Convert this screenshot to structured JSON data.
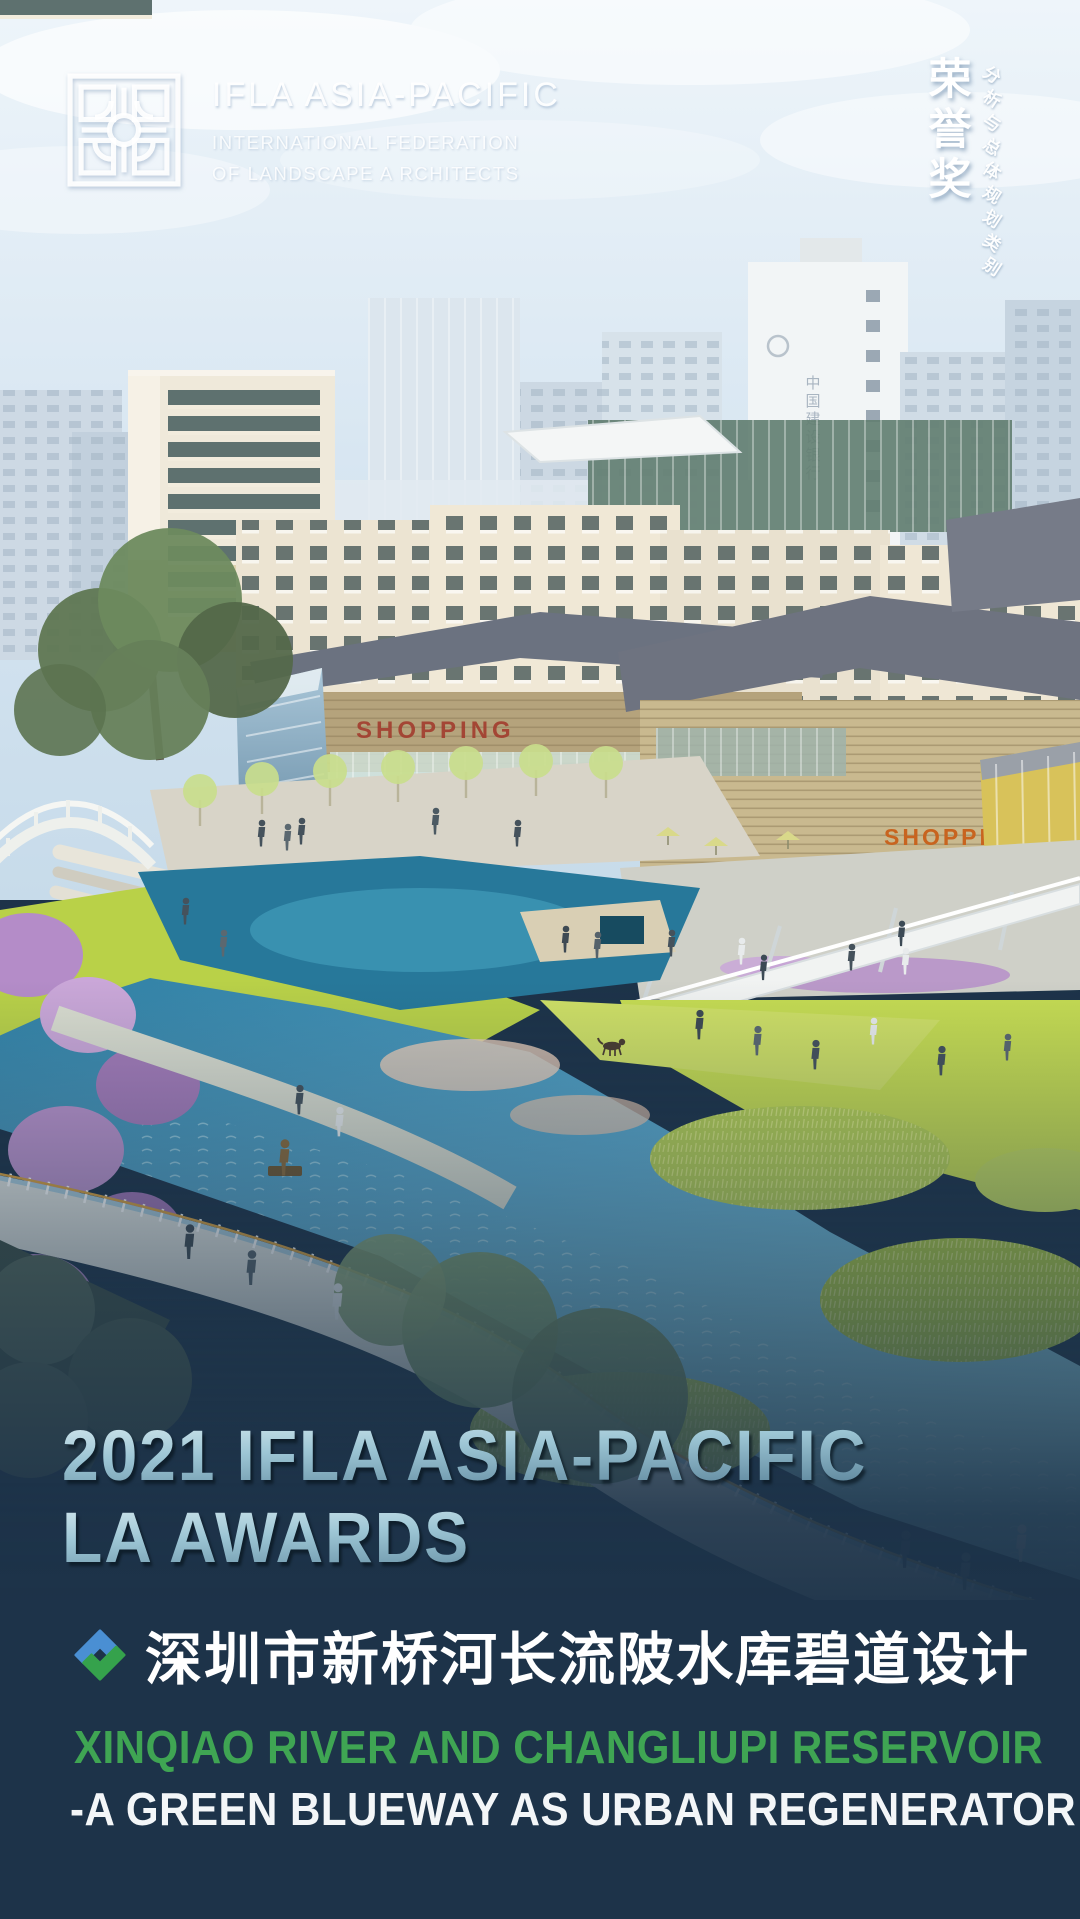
{
  "header": {
    "logo_icon": "ifla-apr-geometric-logo",
    "org_title": "IFLA ASIA-PACIFIC",
    "org_subtitle_line1": "INTERNATIONAL FEDERATION",
    "org_subtitle_line2": "OF LANDSCAPE A RCHITECTS"
  },
  "award_badge": {
    "award_name": "荣誉奖",
    "category": "分析与总体规划类别"
  },
  "scene": {
    "description": "aerial rendering of a green-blue riverside urban regeneration with shopping streets, lawns, wetlands and a winding promenade",
    "signs": {
      "bank_sign": "中国建设银行",
      "mall_sign_center": "SHOPPING",
      "mall_sign_right": "SHOPPI"
    }
  },
  "title_block": {
    "line1": "2021 IFLA ASIA-PACIFIC",
    "line2": "LA AWARDS"
  },
  "project": {
    "badge_icon": "interlocked-diamond-logo",
    "title_zh": "深圳市新桥河长流陂水库碧道设计",
    "subtitle_en_line1": "XINQIAO RIVER AND CHANGLIUPI RESERVOIR",
    "subtitle_en_line2": "-A GREEN BLUEWAY AS URBAN REGENERATOR"
  },
  "colors": {
    "background_navy": "#1d3349",
    "accent_green": "#3fa553",
    "title_blue_light": "#d4e8ee",
    "title_blue_dark": "#567f96",
    "sky_blue": "#dbe9f3",
    "river_blue": "#5aa8cc",
    "lawn_green": "#c6dc52"
  }
}
